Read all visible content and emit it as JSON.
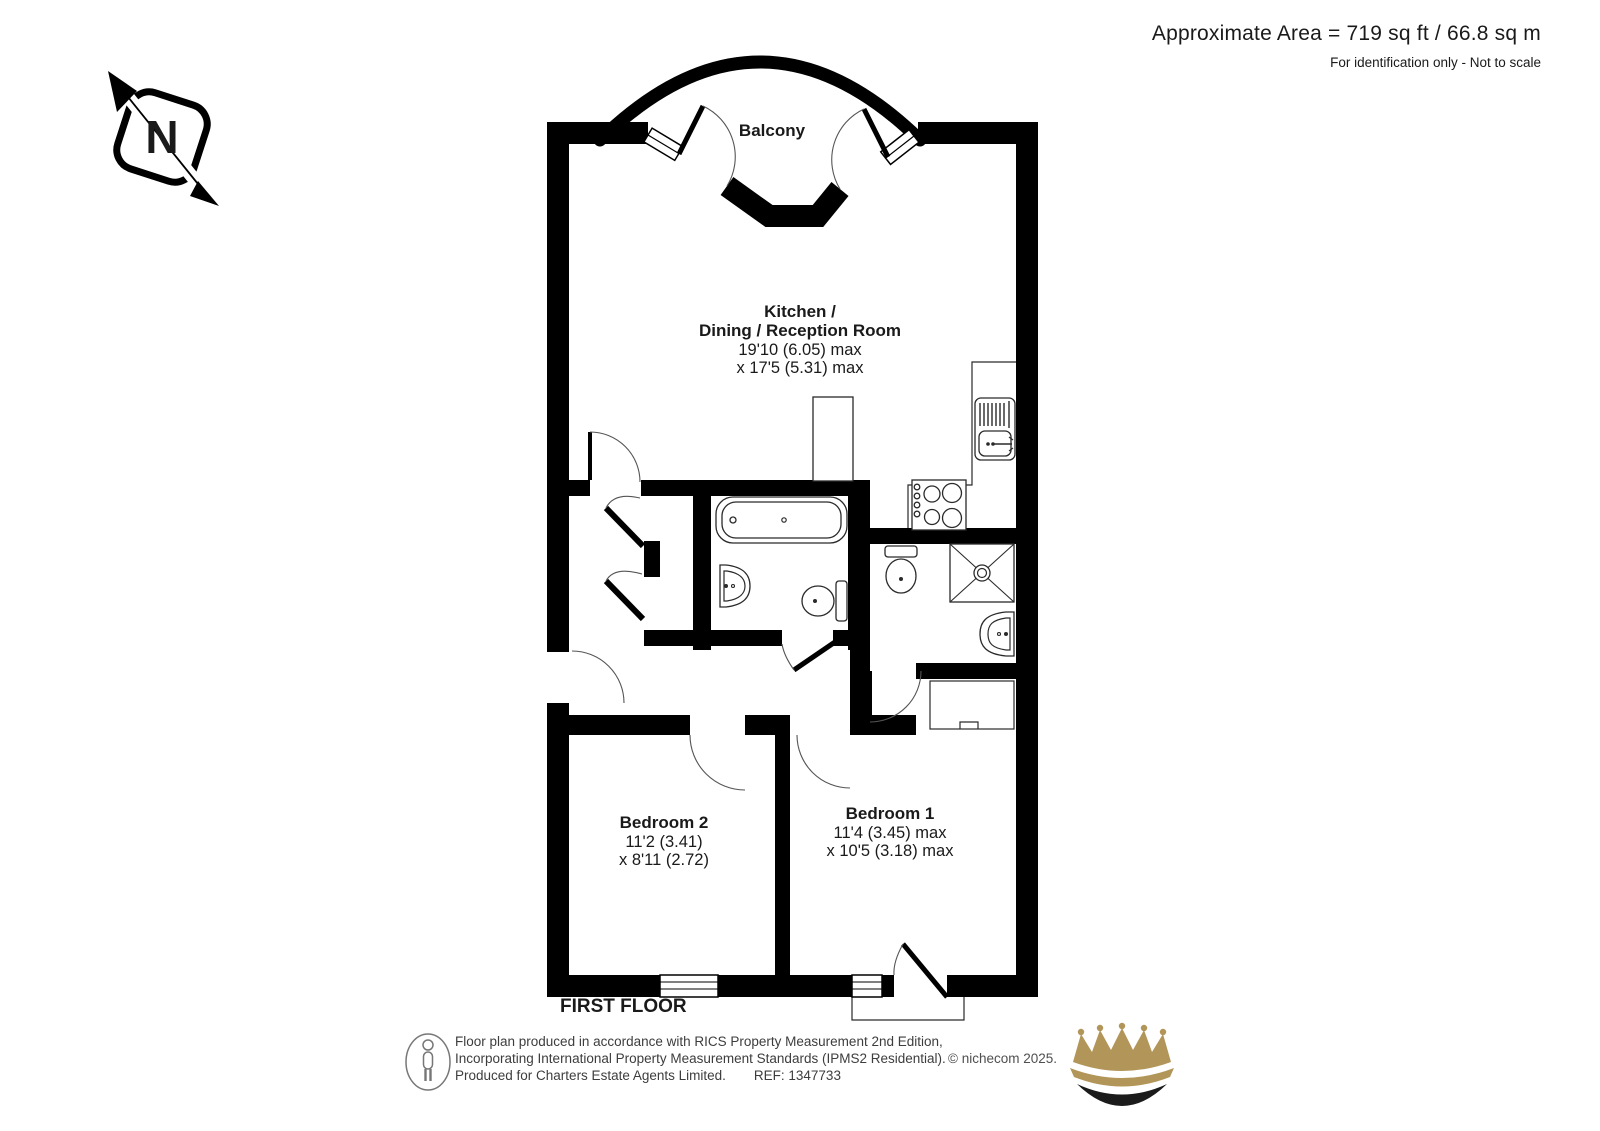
{
  "header": {
    "area_text": "Approximate Area = 719 sq ft / 66.8 sq m",
    "disclaimer": "For identification only - Not to scale"
  },
  "compass": {
    "north_letter": "N"
  },
  "plan": {
    "floor_label": "FIRST FLOOR",
    "rooms": {
      "balcony": {
        "name": "Balcony"
      },
      "kitchen": {
        "name_line1": "Kitchen /",
        "name_line2": "Dining / Reception Room",
        "dims_line1": "19'10 (6.05) max",
        "dims_line2": "x 17'5 (5.31) max"
      },
      "bedroom2": {
        "name": "Bedroom 2",
        "dims_line1": "11'2 (3.41)",
        "dims_line2": "x 8'11 (2.72)"
      },
      "bedroom1": {
        "name": "Bedroom 1",
        "dims_line1": "11'4 (3.45) max",
        "dims_line2": "x 10'5 (3.18) max"
      }
    }
  },
  "footer": {
    "line1": "Floor plan produced in accordance with RICS Property Measurement 2nd Edition,",
    "line2": "Incorporating International Property Measurement Standards (IPMS2 Residential).",
    "line3": "Produced for Charters Estate Agents Limited.",
    "ref": "REF: 1347733",
    "copyright": "© nichecom 2025."
  },
  "colors": {
    "wall": "#000000",
    "crown_gold": "#b29559",
    "crown_dark": "#1b1b1b"
  }
}
